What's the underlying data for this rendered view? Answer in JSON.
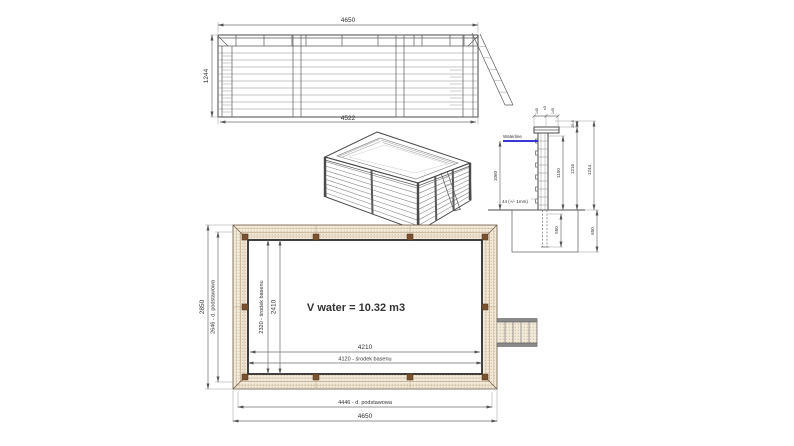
{
  "front_view": {
    "dim_top": "4650",
    "dim_left": "1244",
    "dim_bottom": "4522"
  },
  "section_view": {
    "cap_dim_left": "145",
    "cap_dim_tol": "±5",
    "cap_dim_right": "145",
    "cap_offset": "28.6",
    "waterline_label": "Waterline",
    "water_depth": "1060",
    "wall_height": "1150",
    "height_to_cap": "1216",
    "total_height": "1244",
    "plank_thickness_note": "44 (+/- 1mm)",
    "post_embed_depth": "550",
    "foundation_depth": "650"
  },
  "plan_view": {
    "width_total": "2850",
    "width_base": "2646 - d. podstawowa",
    "width_center": "2320 - środek basenu",
    "width_inner": "2410",
    "volume_note": "V water = 10.32 m3",
    "length_inner": "4210",
    "length_center": "4120 - środek basenu",
    "length_base": "4446 - d. podstawowa",
    "length_total": "4650"
  },
  "colors": {
    "waterline_blue": "#1c1ccb",
    "rim_fill": "#f2ead9",
    "rim_dots": "#b3906f",
    "post_brown": "#7a5230",
    "outline": "#4a4a4a",
    "dimension": "#6f6f6f"
  }
}
